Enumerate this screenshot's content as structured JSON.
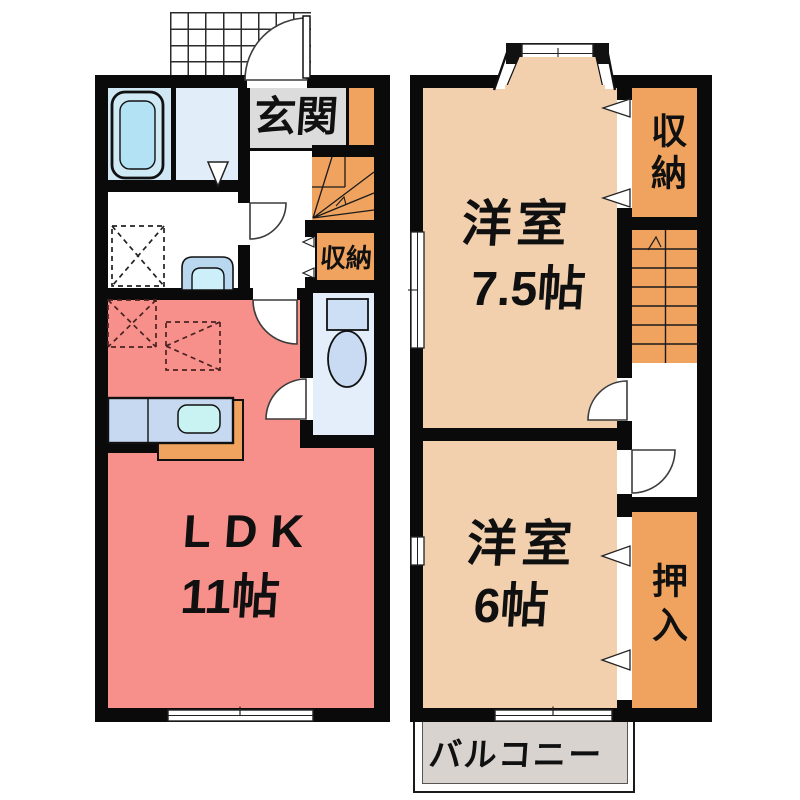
{
  "floor1": {
    "entrance": {
      "label": "玄関"
    },
    "storage": {
      "label": "収納"
    },
    "ldk": {
      "label": "LDK",
      "size": "11帖"
    }
  },
  "floor2": {
    "room_75": {
      "label": "洋室",
      "size": "7.5帖"
    },
    "storage": {
      "label": "収納"
    },
    "room_6": {
      "label": "洋室",
      "size": "6帖"
    },
    "closet": {
      "label": "押入"
    },
    "balcony": {
      "label": "バルコニー"
    }
  },
  "colors": {
    "wall": "#0a0a0a",
    "ldk_floor": "#f7908a",
    "western_room_floor": "#f2cfad",
    "storage_floor": "#f0a35f",
    "entrance_floor": "#dcdcdc",
    "balcony_floor": "#d8d3cf",
    "bathroom_floor": "#cfe8f4",
    "washroom_floor": "#e1edf9",
    "toilet_floor": "#e3eefa",
    "fixture_blue": "#b3e2f4",
    "counter_blue": "#c7d9f0"
  }
}
